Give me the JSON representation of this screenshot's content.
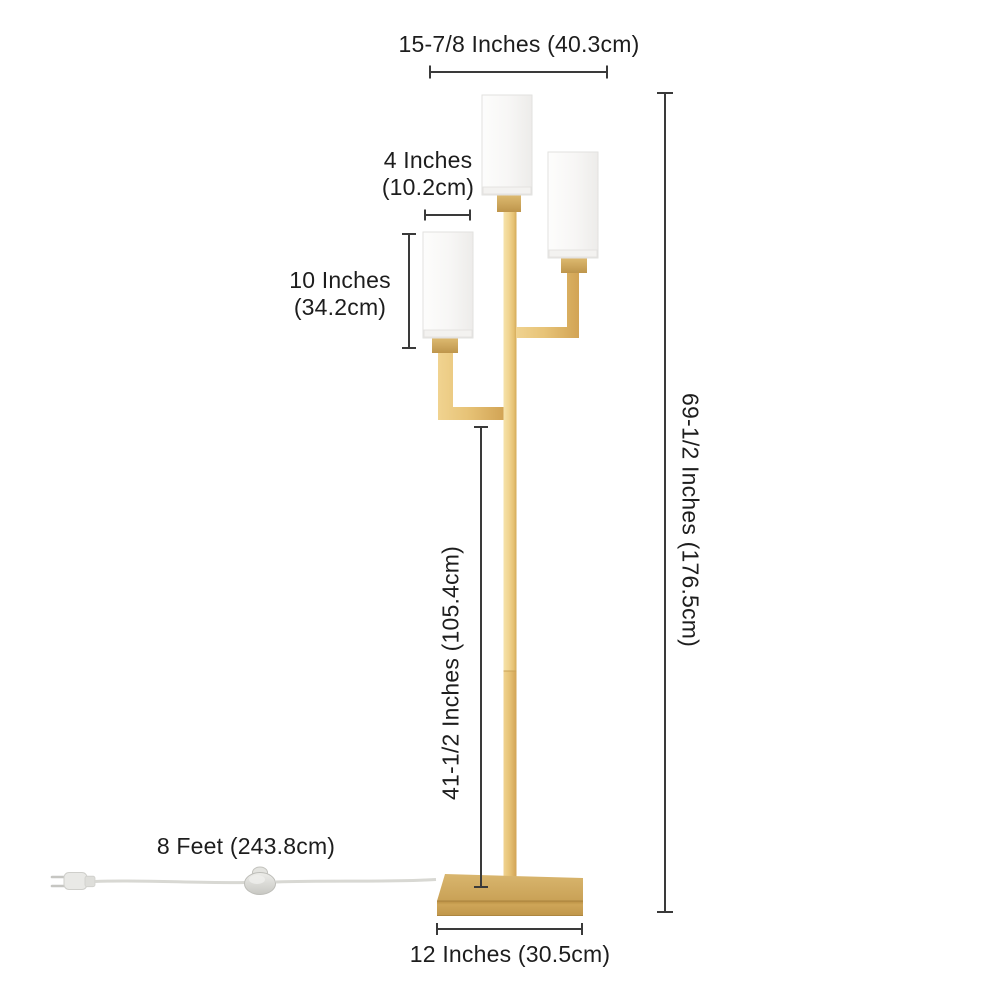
{
  "diagram": {
    "labels": {
      "top_width": "15-7/8 Inches (40.3cm)",
      "shade_width_in": "4 Inches",
      "shade_width_cm": "(10.2cm)",
      "shade_height_in": "10 Inches",
      "shade_height_cm": "(34.2cm)",
      "total_height": "69-1/2 Inches (176.5cm)",
      "pole_height": "41-1/2 Inches (105.4cm)",
      "cord_length": "8 Feet (243.8cm)",
      "base_width": "12 Inches (30.5cm)"
    },
    "colors": {
      "brass_light": "#F6E3AB",
      "brass": "#E6C273",
      "brass_dark": "#C9A156",
      "shade_white": "#F7F6F5",
      "dimension_line": "#3A3A3A",
      "text": "#1D1D1D",
      "cord_gray": "#D8D8D3",
      "background": "#FFFFFF"
    }
  }
}
